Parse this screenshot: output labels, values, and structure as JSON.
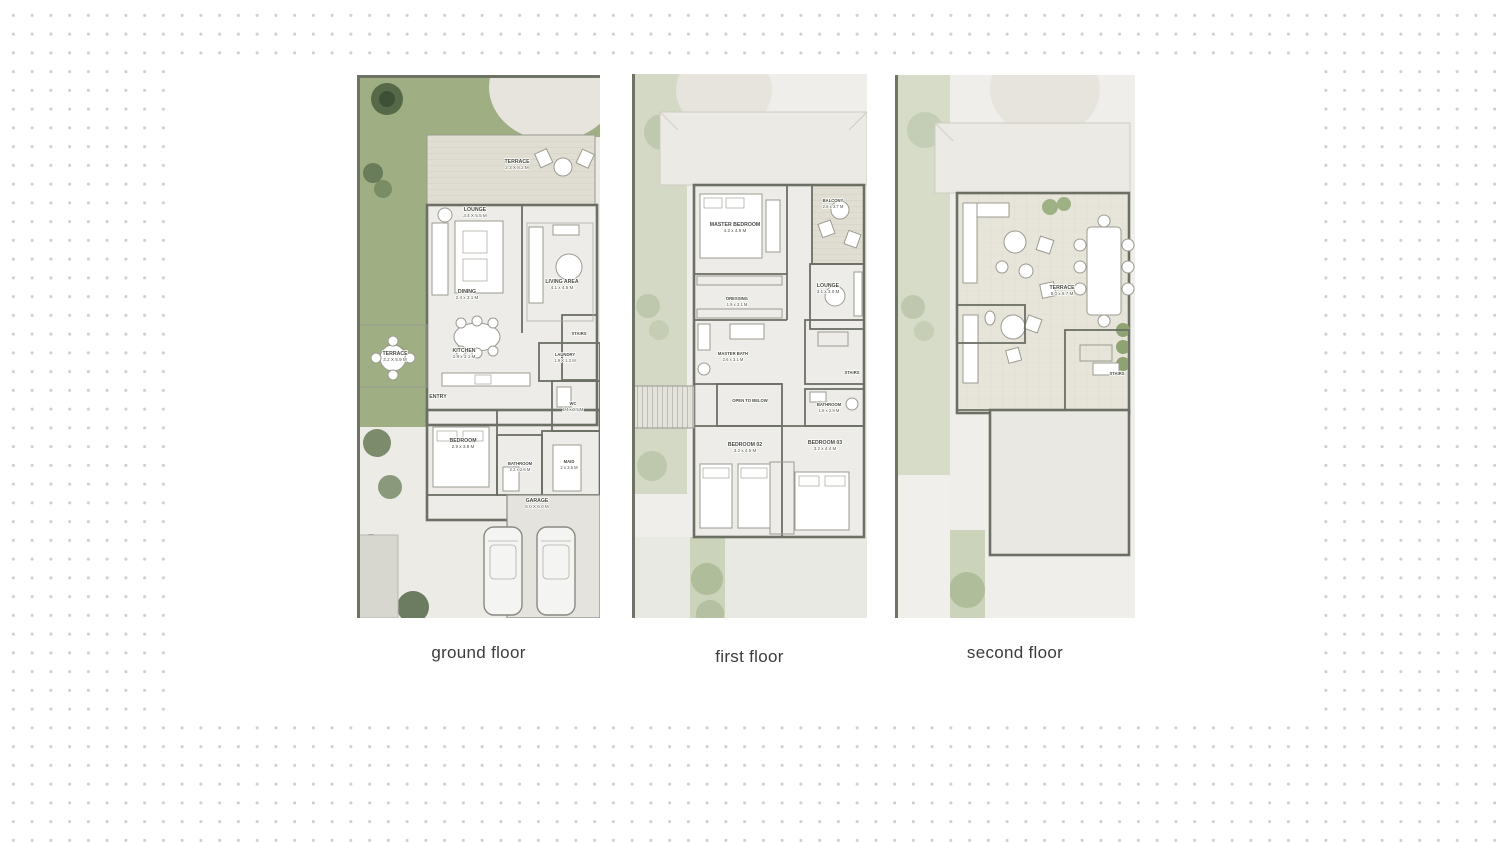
{
  "background": {
    "dot_color": "#d0d0d0",
    "panel_color": "#ffffff"
  },
  "floors": [
    {
      "caption": "ground floor",
      "rooms": [
        {
          "name": "TERRACE",
          "dims": "2.3 X 8.2 M"
        },
        {
          "name": "LOUNGE",
          "dims": "3.4 X 5.5 M"
        },
        {
          "name": "LIVING AREA",
          "dims": "4.1 x 4.5 M"
        },
        {
          "name": "DINING",
          "dims": "2.4 x 3.1 M"
        },
        {
          "name": "TERRACE",
          "dims": "3.2 X 5.9 M"
        },
        {
          "name": "KITCHEN",
          "dims": "2.8 x 3.1 M"
        },
        {
          "name": "STAIRS",
          "dims": ""
        },
        {
          "name": "LAUNDRY",
          "dims": "1.9 X 1.2 M"
        },
        {
          "name": "ENTRY",
          "dims": ""
        },
        {
          "name": "WC",
          "dims": "1.4 x 2.5 M"
        },
        {
          "name": "BEDROOM",
          "dims": "2.9 x 3.8 M"
        },
        {
          "name": "BATHROOM",
          "dims": "2.2 x 2.6 M"
        },
        {
          "name": "MAID",
          "dims": "2 x 3.5 M"
        },
        {
          "name": "GARAGE",
          "dims": "6.0 X 6.0 M"
        }
      ]
    },
    {
      "caption": "first floor",
      "rooms": [
        {
          "name": "MASTER BEDROOM",
          "dims": "4.2 x 4.9 M"
        },
        {
          "name": "BALCONY",
          "dims": "2.5 x 3.7 M"
        },
        {
          "name": "LOUNGE",
          "dims": "3.1 x 3.0 M"
        },
        {
          "name": "DRESSING",
          "dims": "1.9 x 3.1 M"
        },
        {
          "name": "MASTER BATH",
          "dims": "2.6 x 3.1 M"
        },
        {
          "name": "OPEN TO BELOW",
          "dims": ""
        },
        {
          "name": "STAIRS",
          "dims": ""
        },
        {
          "name": "BATHROOM",
          "dims": "1.8 x 2.9 M"
        },
        {
          "name": "BEDROOM 02",
          "dims": "3.2 x 4.5 M"
        },
        {
          "name": "BEDROOM 03",
          "dims": "3.2 x 4.4 M"
        }
      ]
    },
    {
      "caption": "second floor",
      "rooms": [
        {
          "name": "TERRACE",
          "dims": "8.0 x 6.7 M"
        },
        {
          "name": "STAIRS",
          "dims": ""
        }
      ]
    }
  ]
}
